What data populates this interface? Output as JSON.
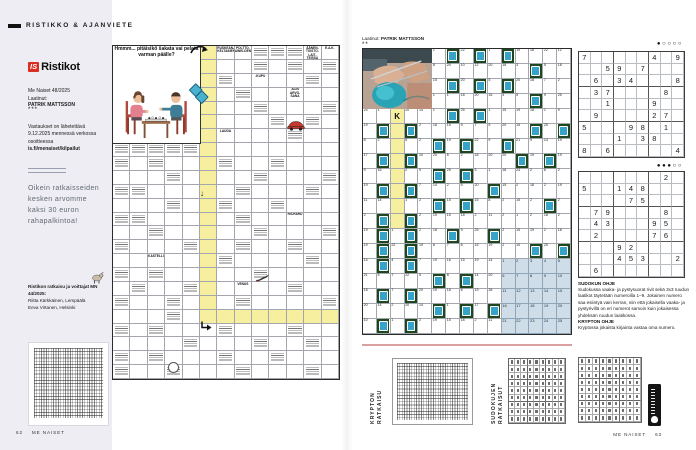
{
  "colors": {
    "lavender": "#ededf3",
    "highlight_yellow": "#f6efa0",
    "block_green": "#1e4620",
    "block_teal": "#35a4c8",
    "reference_blue": "#cfdde8",
    "logo_red": "#d92e21",
    "rule_pink": "#dba1a1"
  },
  "icons": {
    "down_arrow": "↓",
    "corner_arrow": "↳"
  },
  "left_page": {
    "section_header": "RISTIKKO & AJANVIETE",
    "sidebar": {
      "logo_is": "IS",
      "logo_name": "Ristikot",
      "issue": "Me Naiset 48/2025",
      "byline_label": "Laatinut:",
      "byline_name": "PATRIK MATTSSON",
      "stars": "***",
      "submit_info": "Vastaukset on lähetettävä 9.12.2025 mennessä verkossa osoitteessa",
      "submit_url": "is.fi/menaiset/kilpailut",
      "prize_text": "Oikein ratkaisseiden kesken arvomme kaksi 30 euron rahapalkintoa!",
      "solution_header": "Ristikon ratkaisu ja voittajat MN 44/2025:",
      "winners": [
        "Riitta Kärkkäinen, Lempäälä",
        "Eeva Virtanen, Helsinki"
      ]
    },
    "footer": {
      "page_number": "62",
      "magazine": "ME NAISET"
    },
    "crossword": {
      "rows": 24,
      "cols": 13,
      "speech_bubble": "Hmmm... pitäisikö šakata vai pelata varman päälle?",
      "texts": [
        {
          "r": 1,
          "c": 7,
          "t": "RUSKEAN-KELTAINEN"
        },
        {
          "r": 1,
          "c": 8,
          "t": "POLTTO-AINEI-DEN"
        },
        {
          "r": 1,
          "c": 12,
          "t": "ÄÄNEN-TOISTO-LAIT-TEISSA"
        },
        {
          "r": 1,
          "c": 13,
          "t": "E.A.K."
        },
        {
          "r": 3,
          "c": 9,
          "t": "-KUPU"
        },
        {
          "r": 4,
          "c": 11,
          "t": "ALIN ARVO-SANA"
        },
        {
          "r": 7,
          "c": 7,
          "t": "LAUDA"
        },
        {
          "r": 13,
          "c": 11,
          "t": "RICHARD"
        },
        {
          "r": 16,
          "c": 3,
          "t": "KASTELLI"
        },
        {
          "r": 18,
          "c": 8,
          "t": "VENUS"
        }
      ],
      "hatch_cells": [
        [
          1,
          9
        ],
        [
          1,
          10
        ],
        [
          1,
          11
        ],
        [
          8,
          1
        ],
        [
          8,
          2
        ],
        [
          8,
          3
        ],
        [
          8,
          4
        ],
        [
          8,
          5
        ],
        [
          9,
          1
        ],
        [
          11,
          1
        ],
        [
          13,
          1
        ],
        [
          15,
          1
        ],
        [
          17,
          1
        ],
        [
          19,
          1
        ],
        [
          21,
          1
        ],
        [
          23,
          1
        ],
        [
          24,
          1
        ],
        [
          2,
          9
        ],
        [
          2,
          11
        ],
        [
          2,
          13
        ],
        [
          3,
          7
        ],
        [
          3,
          12
        ],
        [
          4,
          8
        ],
        [
          5,
          9
        ],
        [
          5,
          13
        ],
        [
          6,
          10
        ],
        [
          6,
          12
        ],
        [
          7,
          11
        ],
        [
          9,
          3
        ],
        [
          9,
          7
        ],
        [
          9,
          10
        ],
        [
          10,
          4
        ],
        [
          10,
          9
        ],
        [
          10,
          13
        ],
        [
          11,
          2
        ],
        [
          11,
          8
        ],
        [
          11,
          12
        ],
        [
          12,
          4
        ],
        [
          12,
          7
        ],
        [
          12,
          10
        ],
        [
          13,
          2
        ],
        [
          13,
          8
        ],
        [
          14,
          3
        ],
        [
          14,
          9
        ],
        [
          14,
          13
        ],
        [
          15,
          5
        ],
        [
          15,
          8
        ],
        [
          15,
          11
        ],
        [
          16,
          7
        ],
        [
          16,
          12
        ],
        [
          17,
          3
        ],
        [
          17,
          9
        ],
        [
          18,
          2
        ],
        [
          18,
          5
        ],
        [
          18,
          11
        ],
        [
          19,
          4
        ],
        [
          19,
          8
        ],
        [
          19,
          13
        ],
        [
          20,
          4
        ],
        [
          21,
          3
        ],
        [
          21,
          7
        ],
        [
          21,
          11
        ],
        [
          22,
          5
        ],
        [
          22,
          9
        ],
        [
          22,
          12
        ],
        [
          23,
          3
        ],
        [
          23,
          7
        ],
        [
          23,
          10
        ],
        [
          24,
          4
        ],
        [
          24,
          8
        ],
        [
          24,
          12
        ]
      ]
    }
  },
  "right_page": {
    "byline_label": "Laatinut:",
    "byline_name": "PATRIK MATTSSON",
    "stars": "**",
    "krypto": {
      "rows": 19,
      "cols": 15,
      "grid": [
        [
          "P",
          "P",
          "P",
          "P",
          "P",
          "1",
          "B",
          "22",
          "B",
          "1",
          "B",
          "19",
          "18",
          "22",
          "12"
        ],
        [
          "P",
          "P",
          "P",
          "P",
          "P",
          "8",
          "20",
          "10",
          "12",
          "20",
          "18",
          "3",
          "B",
          "5",
          "18"
        ],
        [
          "P",
          "P",
          "P",
          "P",
          "P",
          "15",
          "B",
          "20",
          "B",
          "5",
          "B",
          "20",
          "18",
          "7",
          "2"
        ],
        [
          "P",
          "P",
          "P",
          "P",
          "P",
          "1",
          "1",
          "18",
          "20",
          "15",
          "4",
          "5",
          "B",
          "9",
          "25"
        ],
        [
          "24",
          "1",
          "K",
          "20",
          "14",
          "1",
          "B",
          "25",
          "B",
          "1",
          "15",
          "19",
          "18",
          "1",
          "9"
        ],
        [
          "19",
          "B",
          "Y",
          "B",
          "2",
          "18",
          "15",
          "9",
          "7",
          "5",
          "20",
          "15",
          "B",
          "25",
          "B"
        ],
        [
          "8",
          "2",
          "Y",
          "5",
          "2",
          "B",
          "19",
          "B",
          "22",
          "9",
          "B",
          "21",
          "9",
          "14",
          "19"
        ],
        [
          "17",
          "B",
          "Y",
          "B",
          "10",
          "20",
          "6",
          "2",
          "18",
          "20",
          "20",
          "B",
          "19",
          "B",
          "19"
        ],
        [
          "9",
          "16",
          "Y",
          "2",
          "9",
          "B",
          "25",
          "B",
          "5",
          "1",
          "18",
          "24",
          "2",
          "6",
          "2"
        ],
        [
          "19",
          "B",
          "Y",
          "B",
          "7",
          "14",
          "2",
          "5",
          "20",
          "B",
          "15",
          "2",
          "18",
          "2",
          "19"
        ],
        [
          "11",
          "14",
          "Y",
          "1",
          "2",
          "B",
          "15",
          "B",
          "15",
          "8",
          "2",
          "15",
          "2",
          "B",
          "2"
        ],
        [
          "2",
          "B",
          "Y",
          "B",
          "2",
          "19",
          "15",
          "18",
          "2",
          "11",
          "2",
          "1",
          "2",
          "18",
          "2"
        ],
        [
          "19",
          "B",
          "1",
          "B",
          "2",
          "18",
          "B",
          "9",
          "25",
          "B",
          "2",
          "15",
          "19",
          "2",
          "18"
        ],
        [
          "19",
          "B",
          "22",
          "B",
          "19",
          "8",
          "7",
          "8",
          "15",
          "19",
          "2",
          "10",
          "B",
          "25",
          "B"
        ],
        [
          "14",
          "B",
          "4",
          "B",
          "7",
          "19",
          "16",
          "15",
          "19",
          "14",
          "T1",
          "T2",
          "T3",
          "T4",
          "T5"
        ],
        [
          "21",
          "5",
          "7",
          "22",
          "5",
          "B",
          "8",
          "B",
          "14",
          "20",
          "T6",
          "T7",
          "T8",
          "T9",
          "T10"
        ],
        [
          "18",
          "B",
          "7",
          "B",
          "20",
          "19",
          "18",
          "8",
          "19",
          "18",
          "T11",
          "T12",
          "T13",
          "T14",
          "T15"
        ],
        [
          "20",
          "14",
          "2",
          "20",
          "14",
          "B",
          "1",
          "B",
          "17",
          "B",
          "T16",
          "T17",
          "T18",
          "T19",
          "T20"
        ],
        [
          "10",
          "B",
          "1",
          "B",
          "2",
          "19",
          "15",
          "18",
          "2",
          "11",
          "T21",
          "T22",
          "T23",
          "T24",
          "T25"
        ]
      ]
    },
    "sudoku1": {
      "difficulty": "●○○○○",
      "givens": [
        "7.....4.9",
        "..59.7...",
        ".6.34...8",
        ".37....8.",
        "..1...9..",
        ".9....27.",
        "5...98.1.",
        "...1.38..",
        "8.6.....4"
      ]
    },
    "sudoku2": {
      "difficulty": "●●●○○",
      "givens": [
        ".......2.",
        "5..148...",
        "....75...",
        ".79....8.",
        ".43...95.",
        ".2....76.",
        "...92....",
        "...453..2",
        ".6......."
      ]
    },
    "sudoku_help_title": "SUDOKUN OHJE",
    "sudoku_help_text": "Sudokussa vaaka- ja pystysuorat rivit sekä 3x3 ruudun laatikot täytetään numeroilla 1–9. Jokainen numero saa esiintyä vain kerran, niin että jokaisella vaaka- ja pystyrivillä on eri numerot samoin kuin jokaisessa yhdeksän ruudun laatikossa.",
    "krypto_help_title": "KRYPTON OHJE",
    "krypto_help_text": "Kryptossa jokaista kirjainta vastaa oma numero.",
    "solutions": {
      "krypton_label_line1": "KRYPTON",
      "krypton_label_line2": "RATKAISU",
      "sudoku_label_line1": "SUDOKUJEN",
      "sudoku_label_line2": "RATKAISUT"
    },
    "footer": {
      "magazine": "ME NAISET",
      "page_number": "63"
    }
  }
}
